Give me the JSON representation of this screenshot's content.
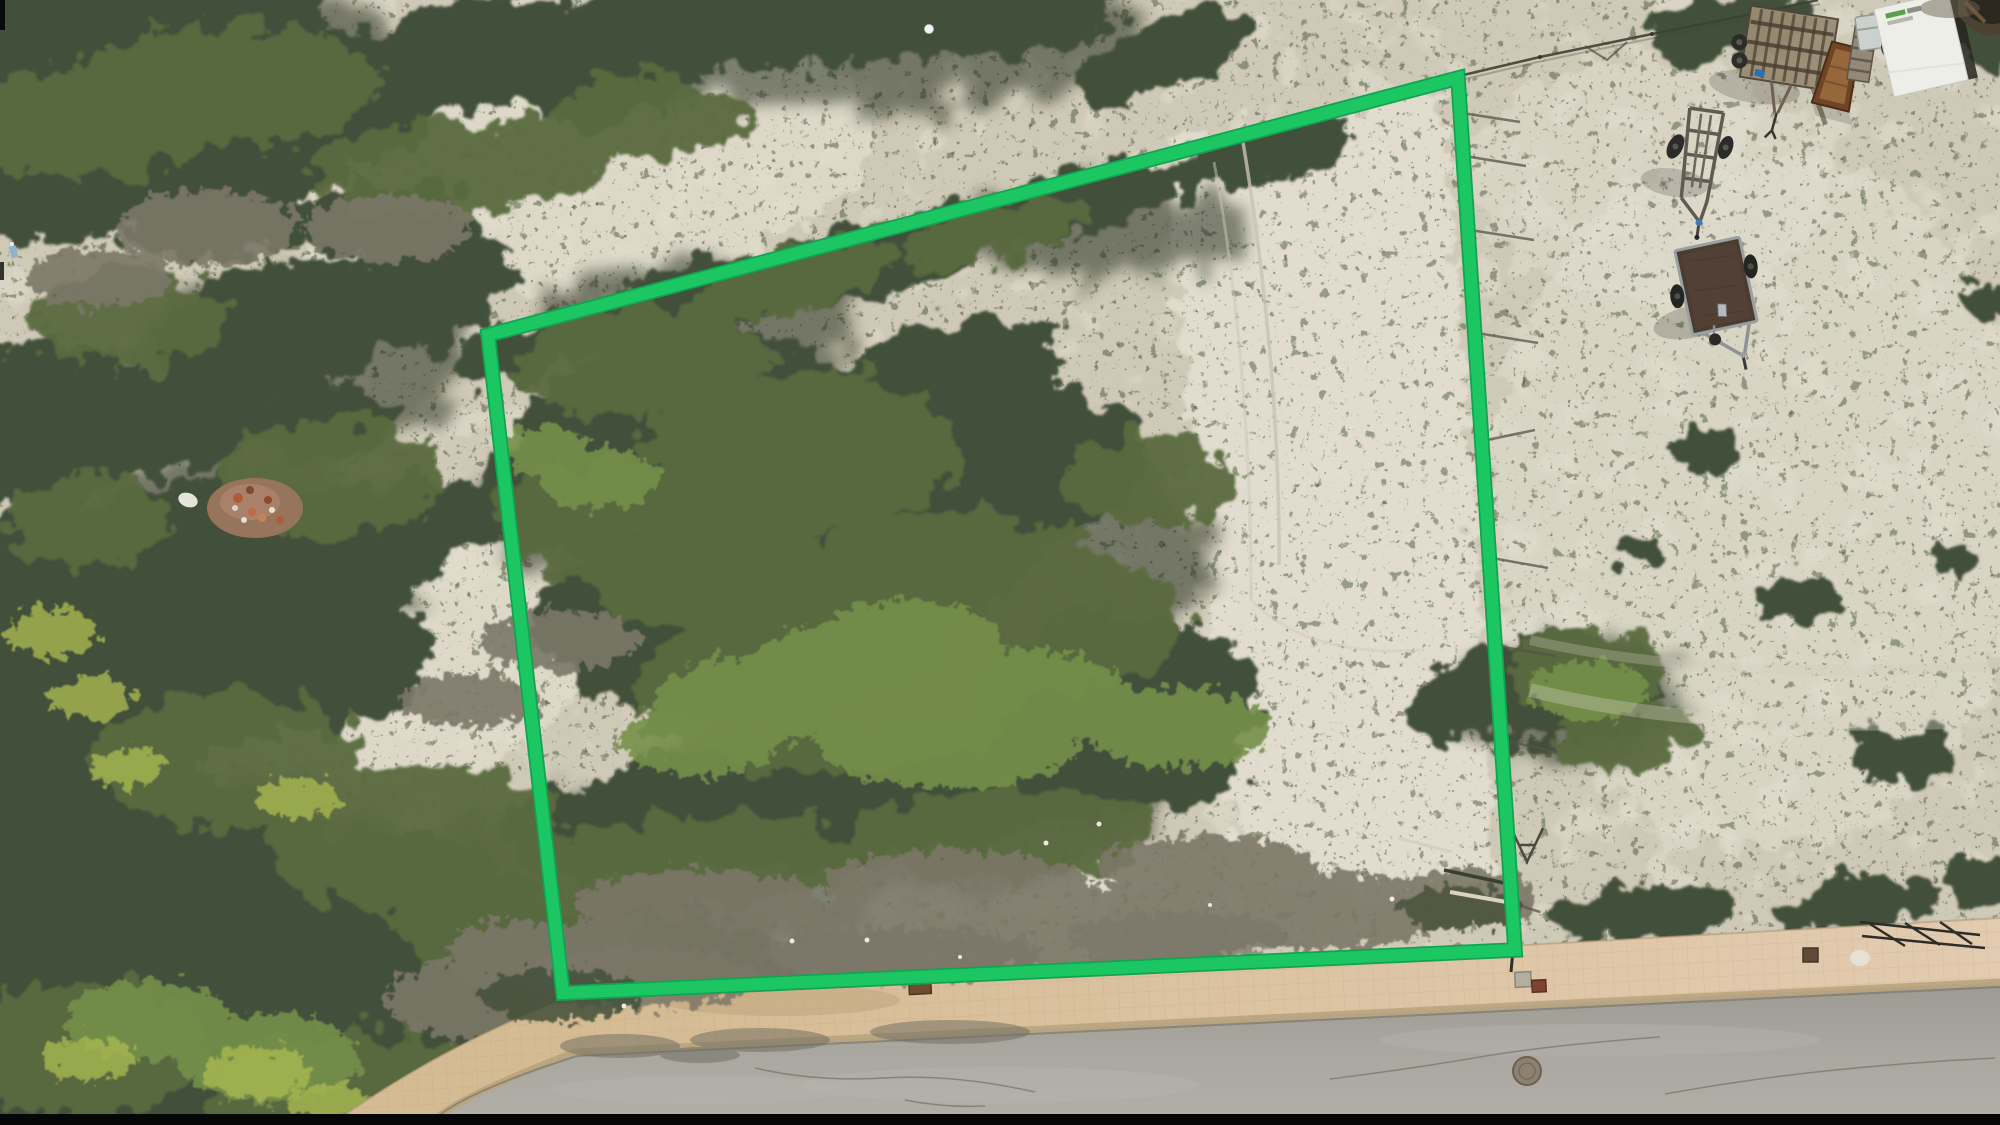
{
  "window": {
    "title": "Aerial drone photo of a vacant sandy plot outlined in green beside a road"
  },
  "scene": {
    "type": "aerial-photo",
    "ground": "sandy dune scrubland with patchy shrubs",
    "road_position": "bottom edge, curving from lower-left to right",
    "items": [
      "plot-boundary-overlay",
      "boat-trailer",
      "flatbed-trailer",
      "wooden-rack-trailer",
      "wood-chute",
      "pallet",
      "cooler-box",
      "sign-board",
      "sidewalk",
      "road",
      "manhole-cover",
      "debris-pile",
      "fence-line",
      "fence-post-shadows",
      "letterbox-bar"
    ]
  },
  "annotation": {
    "outline_points": "488,335 1458,78 1515,950 563,993",
    "outline_color": "#1CC763",
    "outline_edge_color": "#12A352",
    "outline_width": 12,
    "outline_edge_width": 15.5
  },
  "palette": {
    "sand": "#CFC9B7",
    "sand_bright": "#E2DECF",
    "veg_dark": "#43503A",
    "veg_mid": "#5A6B41",
    "veg_bright": "#74904C",
    "veg_accent": "#A9B851",
    "dead_brush": "#7B7768",
    "shadow": "#1F2819",
    "road": "#A8A59E",
    "sidewalk_left": "#D5BB93",
    "sidewalk_right": "#E3CBB1",
    "curb": "#B9A47F",
    "deck_brown": "#4B3B31",
    "trailer_metal": "#8D9292",
    "wheel": "#2B2B28",
    "wood": "#9A8C74",
    "sign_white": "#EDEEE7",
    "chute_brown": "#6F4526",
    "letterbox": "#070707"
  }
}
